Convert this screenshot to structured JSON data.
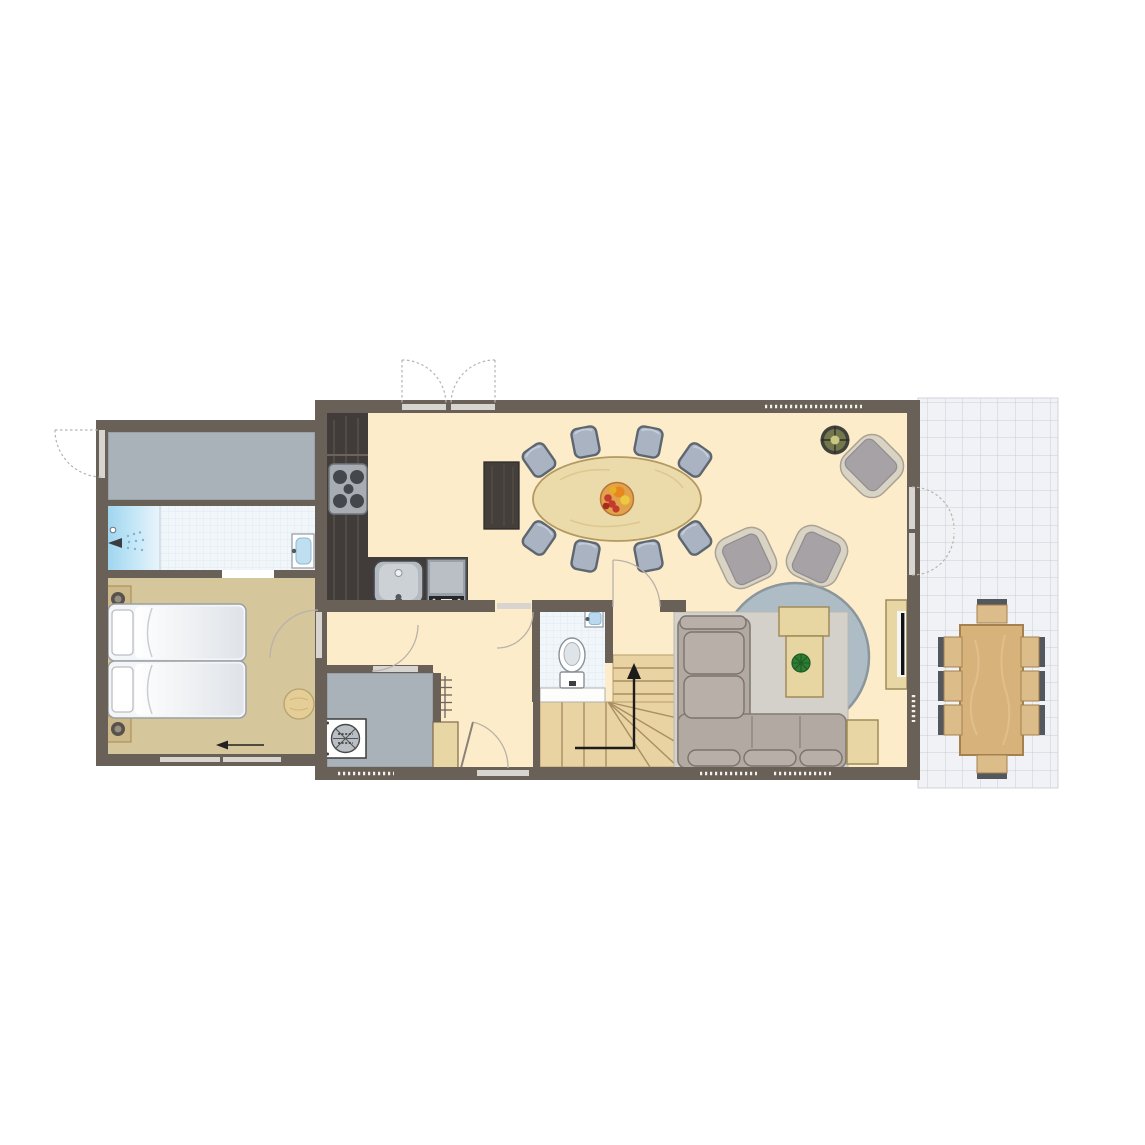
{
  "plan": {
    "type": "floor-plan",
    "level": "ground-floor",
    "visible_text": "",
    "rooms": [
      {
        "name": "storage-room",
        "floor": "gray",
        "furniture": [
          "exterior-door"
        ]
      },
      {
        "name": "bathroom",
        "floor": "tiled",
        "furniture": [
          "shower",
          "washbasin"
        ]
      },
      {
        "name": "bedroom",
        "floor": "tan",
        "furniture": [
          "single-bed",
          "single-bed",
          "nightstand-with-lamp",
          "nightstand-with-lamp",
          "pouf",
          "direction-arrow"
        ]
      },
      {
        "name": "kitchen",
        "floor": "cream",
        "furniture": [
          "l-shaped-counter",
          "stove-4-burners",
          "sink",
          "oven",
          "tall-cabinet"
        ]
      },
      {
        "name": "dining-area",
        "floor": "cream",
        "furniture": [
          "oval-table",
          "fruit-bowl",
          "chairs-x8",
          "double-garden-doors"
        ]
      },
      {
        "name": "living-room",
        "floor": "cream",
        "furniture": [
          "corner-sofa",
          "round-rug",
          "coffee-table-with-plant",
          "armchair",
          "armchair",
          "armchair",
          "side-table",
          "tv-cabinet",
          "potted-plant",
          "terrace-doors-x2"
        ]
      },
      {
        "name": "hallway",
        "floor": "cream",
        "furniture": [
          "radiator",
          "wardrobe",
          "front-door"
        ]
      },
      {
        "name": "toilet",
        "floor": "tiled",
        "furniture": [
          "toilet",
          "hand-basin"
        ]
      },
      {
        "name": "utility-room",
        "floor": "gray",
        "furniture": [
          "washing-machine"
        ]
      },
      {
        "name": "staircase",
        "furniture": [
          "winder-stairs",
          "up-arrow"
        ]
      },
      {
        "name": "terrace",
        "floor": "white-tiles",
        "furniture": [
          "rect-dining-table",
          "chairs-x8"
        ]
      }
    ],
    "counts": {
      "dining_chairs": 8,
      "terrace_chairs": 8,
      "armchairs": 3,
      "beds": 2,
      "doors_double": 2
    }
  },
  "colors": {
    "wall": "#696058",
    "floor_main": "#fdecca",
    "floor_bedroom": "#d6c69c",
    "floor_utility": "#a9b1b9",
    "terrace_tile": "#f1f2f5",
    "terrace_grid": "#c9cdd7",
    "bath_tile": "#f1f6fa",
    "bath_grid": "#dbe7f1",
    "shower_blue": "#b5e0f4",
    "kitchen_dark_wood": "#413c39",
    "dining_table_wood": "#ecdbaa",
    "chair_gray": "#a9b3c2",
    "chair_border": "#5e6670",
    "rug_gray": "#adbcc5",
    "sofa_gray": "#b2a9a2",
    "armchair_seat": "#a6a2a5",
    "armchair_frame": "#d8d3c3",
    "stairs_wood": "#ead3a3",
    "terrace_table_wood": "#d8b27b",
    "outdoor_chair_back": "#53585e",
    "outdoor_chair_seat": "#dcbd8a",
    "door_leaf": "#d8d4d0",
    "arc_line": "#b9b2aa",
    "plant_green": "#2f7c34",
    "fruit_red": "#c23b2e",
    "fruit_orange": "#e8871f",
    "fruit_yellow": "#ecc93e",
    "bed_white": "#f4f5f7",
    "accent_tan": "#cdb98a"
  }
}
